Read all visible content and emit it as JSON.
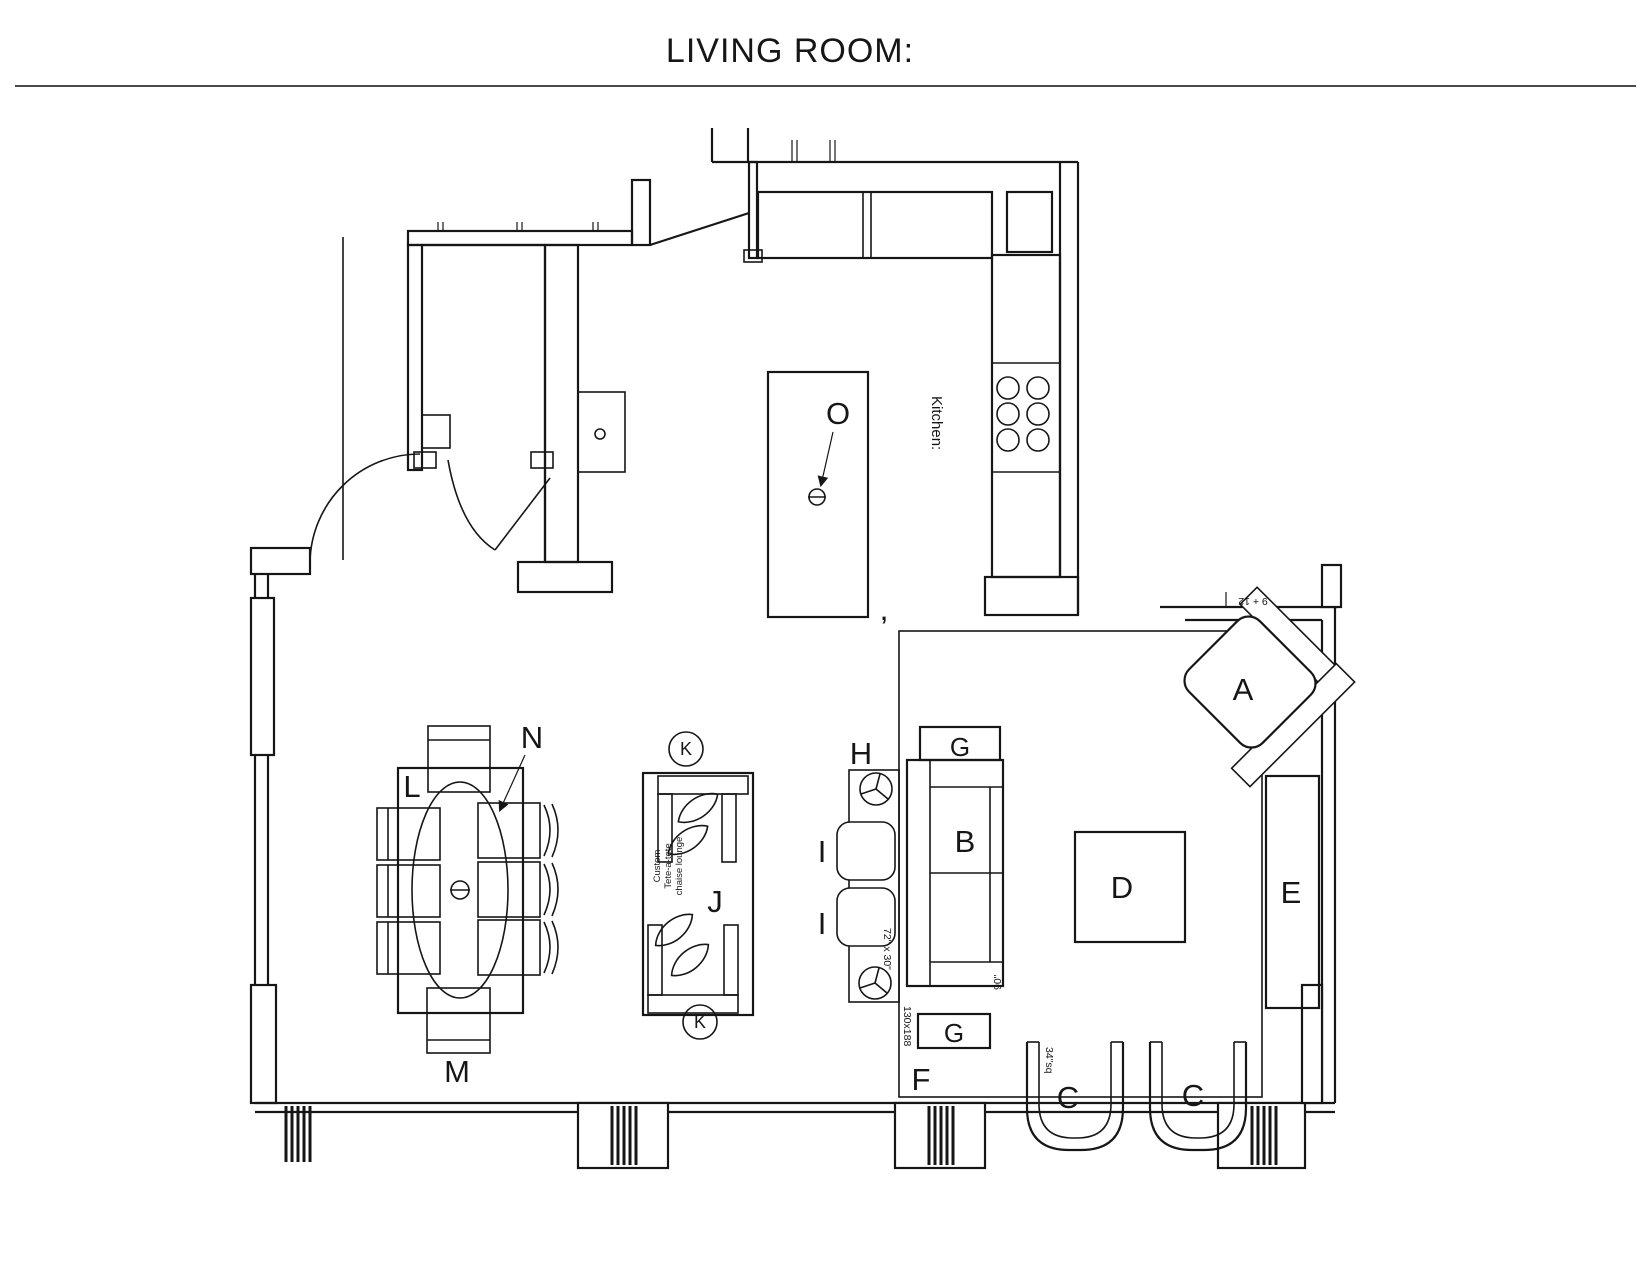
{
  "title": "LIVING ROOM:",
  "rooms": {
    "kitchen": "Kitchen:"
  },
  "labels": {
    "a": "A",
    "b": "B",
    "c1": "C",
    "c2": "C",
    "d": "D",
    "e": "E",
    "f": "F",
    "g1": "G",
    "g2": "G",
    "h": "H",
    "i1": "I",
    "i2": "I",
    "j": "J",
    "k1": "K",
    "k2": "K",
    "l": "L",
    "m": "M",
    "n": "N",
    "o": "O"
  },
  "annotations": {
    "chaise_line1": "Custom",
    "chaise_line2": "Tete-a-tete",
    "chaise_line3": "chaise lounge",
    "sofa_length": "90\"",
    "console_dims": "72\" x 30\"",
    "chair_size": "34\"sq",
    "rug_size": "130x188",
    "wall_dim": "9 + 12",
    "separator": ","
  }
}
